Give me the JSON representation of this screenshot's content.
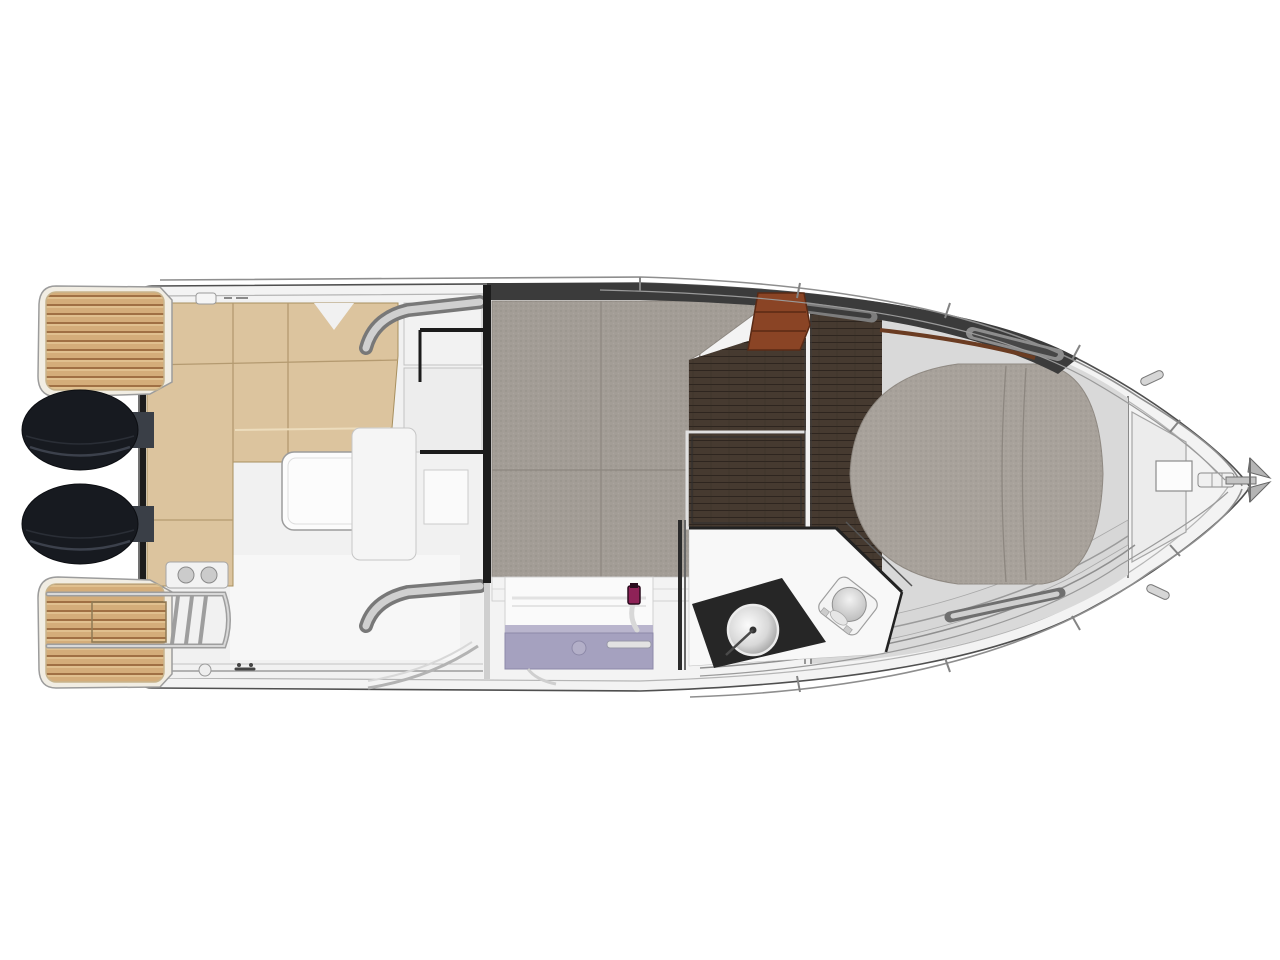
{
  "title": "Motor boat deck and cabin floor plan (top-down cutaway)",
  "diagram": {
    "type": "boat-floor-plan",
    "view": "overhead plan, bow pointing right, cutaway showing cabin interior",
    "background": "#ffffff",
    "parts": [
      {
        "id": "swim-platform-port",
        "label": "Teak swim platform (port, aft)"
      },
      {
        "id": "swim-platform-starboard",
        "label": "Teak swim platform (starboard, aft) with boarding ladder"
      },
      {
        "id": "outboard-engine-port",
        "label": "Outboard engine (port)"
      },
      {
        "id": "outboard-engine-starboard",
        "label": "Outboard engine (starboard)"
      },
      {
        "id": "cockpit-seating",
        "label": "L-shaped cockpit bench seating"
      },
      {
        "id": "cockpit-table",
        "label": "Cockpit table"
      },
      {
        "id": "helm-console",
        "label": "Helm console / companionway entry"
      },
      {
        "id": "aft-cabin-berth",
        "label": "Aft cabin double berth"
      },
      {
        "id": "companionway-steps",
        "label": "Wooden companionway steps"
      },
      {
        "id": "galley",
        "label": "Galley unit with sink and faucet"
      },
      {
        "id": "head-compartment",
        "label": "Head (bathroom) with round sink and toilet"
      },
      {
        "id": "forward-berth",
        "label": "Forward island berth"
      },
      {
        "id": "foredeck",
        "label": "Foredeck with windlass and bow roller"
      },
      {
        "id": "anchor",
        "label": "Anchor at bow tip"
      },
      {
        "id": "railings",
        "label": "Bow rails and grab handles"
      }
    ]
  },
  "colors": {
    "hull_fill": "#f3f3f3",
    "hull_stroke": "#4f4f4f",
    "line_dark": "#1c1c1c",
    "cushion": "#dcc49e",
    "cushion_seam": "#b49a70",
    "engine": "#171a20",
    "berth_fabric": "#a39d96",
    "bed_fabric": "#a8a29b",
    "fabric_seam": "#8d8780",
    "floor_wood": "#463a30",
    "steps_wood": "#8a4425",
    "galley_counter": "#a5a1bf",
    "faucet_accent": "#8e2257",
    "head_counter": "#262626",
    "dark_band": "#3b3b3b",
    "walkway": "#d7d7d7",
    "cabin_base": "#d9d9d9",
    "metal": "#b5b5b5"
  }
}
